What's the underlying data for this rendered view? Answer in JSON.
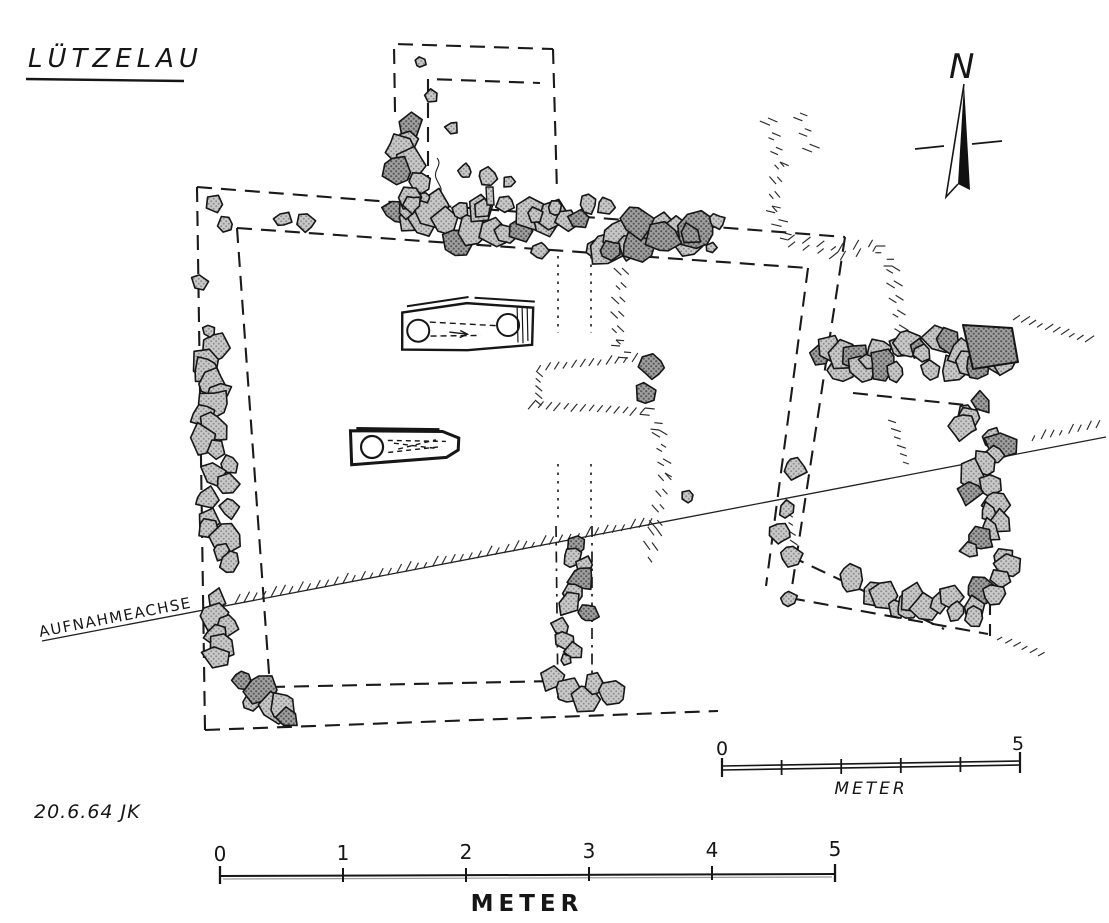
{
  "title": "LÜTZELAU",
  "annotations": {
    "north_label": "N",
    "axis_label": "AUFNAHMEACHSE",
    "date_signature": "20.6.64 JK"
  },
  "scale_bar_main": {
    "unit_label": "METER",
    "tick_labels": [
      "0",
      "1",
      "2",
      "3",
      "4",
      "5"
    ]
  },
  "scale_bar_small": {
    "unit_label": "METER",
    "tick_labels": [
      "0",
      "5"
    ]
  },
  "colors": {
    "ink": "#1a1a1a",
    "stone_fill": "#c9c9c9",
    "stone_fill_dark": "#a3a3a3",
    "background": "#ffffff"
  }
}
